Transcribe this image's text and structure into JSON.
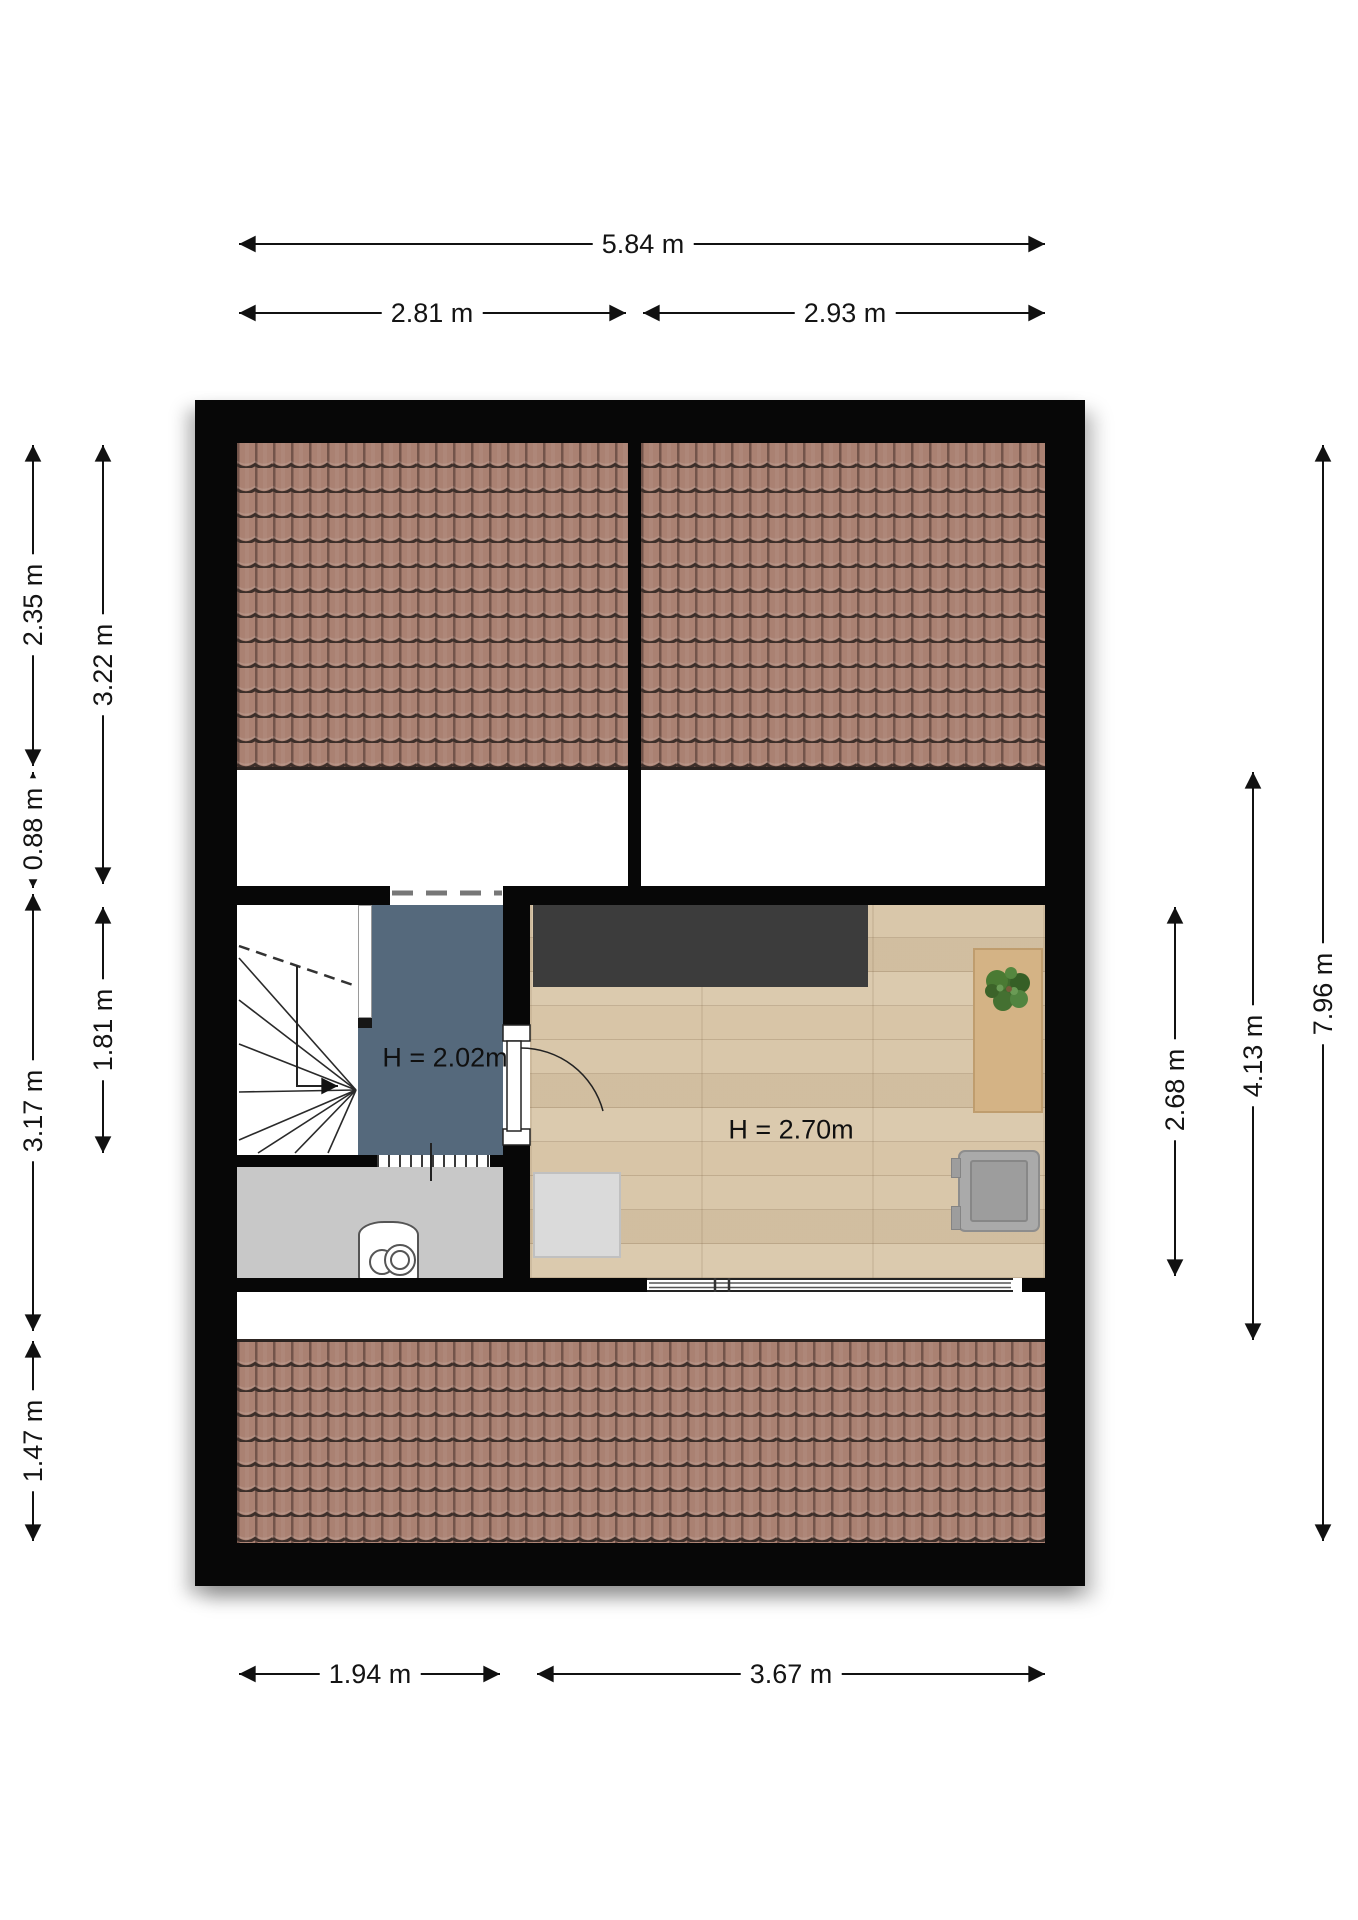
{
  "floorplan": {
    "dimensions": {
      "top_total": "5.84 m",
      "top_left": "2.81 m",
      "top_right": "2.93 m",
      "left_outer": [
        "2.35 m",
        "0.88 m",
        "3.17 m",
        "1.47 m"
      ],
      "left_inner": [
        "3.22 m",
        "1.81 m"
      ],
      "right_room": "2.68 m",
      "right_middle": "4.13 m",
      "right_total": "7.96 m",
      "bottom_left": "1.94 m",
      "bottom_right": "3.67 m"
    },
    "rooms": {
      "landing_height": "H = 2.02m",
      "attic_room_height": "H = 2.70m"
    },
    "colors": {
      "wall": "#070707",
      "roof_tiles": "#aa8172",
      "landing_floor": "#55697c",
      "storage_floor": "#c8c8c8",
      "wood_floor": "#d8c5a7",
      "closet_dark": "#3c3c3c",
      "table_wood": "#d4b385",
      "plant_green": "#3f6b2d"
    }
  }
}
